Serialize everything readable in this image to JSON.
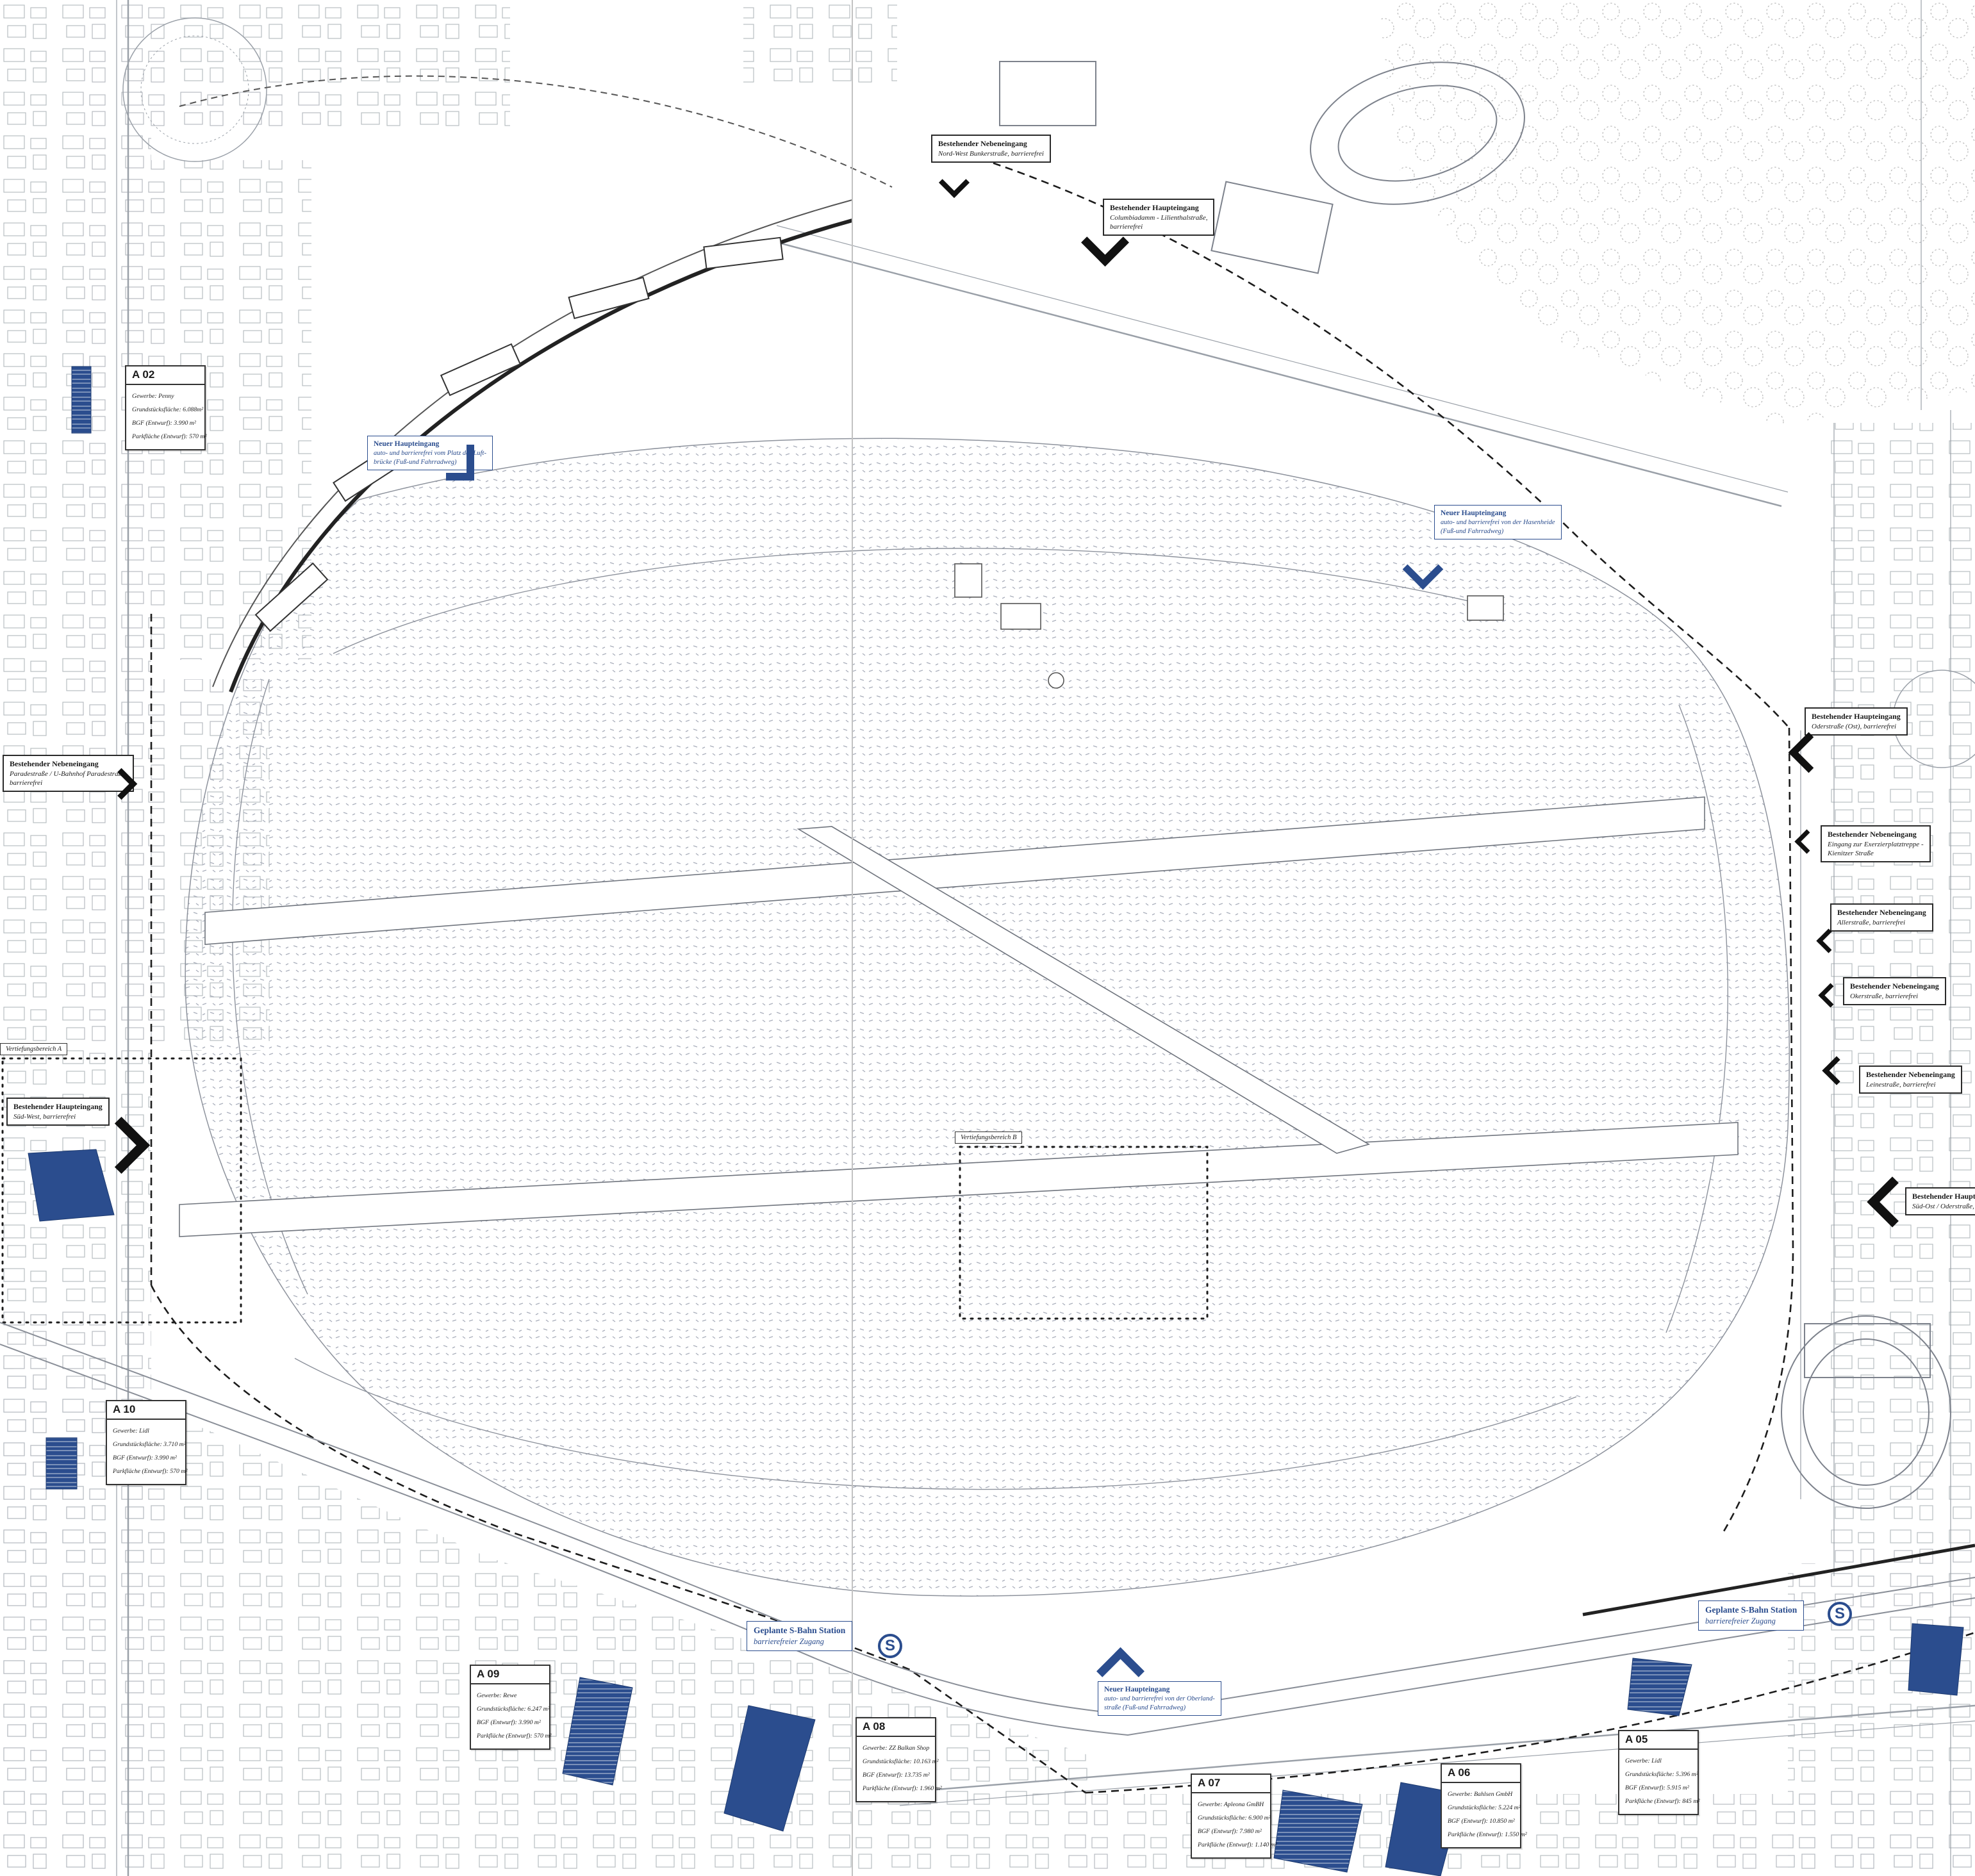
{
  "accent_color": "#2b4d8e",
  "parcels": [
    {
      "id": "A 02",
      "fields": [
        "Gewerbe: Penny",
        "Grundstücksfläche: 6.088m²",
        "BGF (Entwurf): 3.990 m²",
        "Parkfläche (Entwurf): 570 m²"
      ]
    },
    {
      "id": "A 05",
      "fields": [
        "Gewerbe: Lidl",
        "Grundstücksfläche: 5.396 m²",
        "BGF (Entwurf): 5.915 m²",
        "Parkfläche (Entwurf): 845 m²"
      ]
    },
    {
      "id": "A 06",
      "fields": [
        "Gewerbe: Bahlsen GmbH",
        "Grundstücksfläche: 5.224 m²",
        "BGF (Entwurf): 10.850 m²",
        "Parkfläche (Entwurf): 1.550 m²"
      ]
    },
    {
      "id": "A 07",
      "fields": [
        "Gewerbe: Apleona GmBH",
        "Grundstücksfläche: 6.900 m²",
        "BGF (Entwurf): 7.980 m²",
        "Parkfläche (Entwurf): 1.140 m²"
      ]
    },
    {
      "id": "A 08",
      "fields": [
        "Gewerbe: ZZ Balkan Shop",
        "Grundstücksfläche: 10.163 m²",
        "BGF (Entwurf): 13.735 m²",
        "Parkfläche (Entwurf): 1.960 m²"
      ]
    },
    {
      "id": "A 09",
      "fields": [
        "Gewerbe: Rewe",
        "Grundstücksfläche: 6.247 m²",
        "BGF (Entwurf): 3.990 m²",
        "Parkfläche (Entwurf): 570 m²"
      ]
    },
    {
      "id": "A 10",
      "fields": [
        "Gewerbe: Lidl",
        "Grundstücksfläche: 3.710 m²",
        "BGF (Entwurf): 3.990 m²",
        "Parkfläche (Entwurf): 570 m²"
      ]
    }
  ],
  "existing_entrances": [
    {
      "title": "Bestehender Nebeneingang",
      "body": [
        "Nord-West Bunkerstraße, barrierefrei",
        ""
      ]
    },
    {
      "title": "Bestehender Haupteingang",
      "body": [
        "Columbiadamm - Lilienthalstraße,",
        "barrierefrei"
      ]
    },
    {
      "title": "Bestehender Haupteingang",
      "body": [
        "Oderstraße (Ost), barrierefrei",
        ""
      ]
    },
    {
      "title": "Bestehender Nebeneingang",
      "body": [
        "Eingang zur Exerzierplatztreppe -",
        "Kienitzer Straße"
      ]
    },
    {
      "title": "Bestehender Nebeneingang",
      "body": [
        "Allerstraße, barrierefrei",
        ""
      ]
    },
    {
      "title": "Bestehender Nebeneingang",
      "body": [
        "Okerstraße, barrierefrei",
        ""
      ]
    },
    {
      "title": "Bestehender Nebeneingang",
      "body": [
        "Leinestraße, barrierefrei",
        ""
      ]
    },
    {
      "title": "Bestehender Nebeneingang",
      "body": [
        "Paradestraße / U-Bahnhof Paradestraße,",
        "barrierefrei"
      ]
    },
    {
      "title": "Bestehender Haupteingang",
      "body": [
        "Süd-West, barrierefrei",
        ""
      ]
    },
    {
      "title": "Bestehender Haupteingang",
      "body": [
        "Süd-Ost / Oderstraße, barrierefrei",
        ""
      ]
    }
  ],
  "new_entrances": [
    {
      "title": "Neuer Haupteingang",
      "body": [
        "auto- und barrierefrei vom Platz der Luft-",
        "brücke (Fuß-und Fahrradweg)"
      ]
    },
    {
      "title": "Neuer Haupteingang",
      "body": [
        "auto- und barrierefrei von der Hasenheide",
        "(Fuß-und Fahrradweg)"
      ]
    },
    {
      "title": "Neuer Haupteingang",
      "body": [
        "auto- und barrierefrei von der Oberland-",
        "straße (Fuß-und Fahrradweg)"
      ]
    }
  ],
  "sbahn_stations": [
    {
      "title": "Geplante S-Bahn Station",
      "subtitle": "barrierefreier Zugang",
      "symbol": "S"
    },
    {
      "title": "Geplante S-Bahn Station",
      "subtitle": "barrierefreier Zugang",
      "symbol": "S"
    }
  ],
  "study_areas": [
    {
      "label": "Vertiefungsbereich A"
    },
    {
      "label": "Vertiefungsbereich B"
    }
  ]
}
